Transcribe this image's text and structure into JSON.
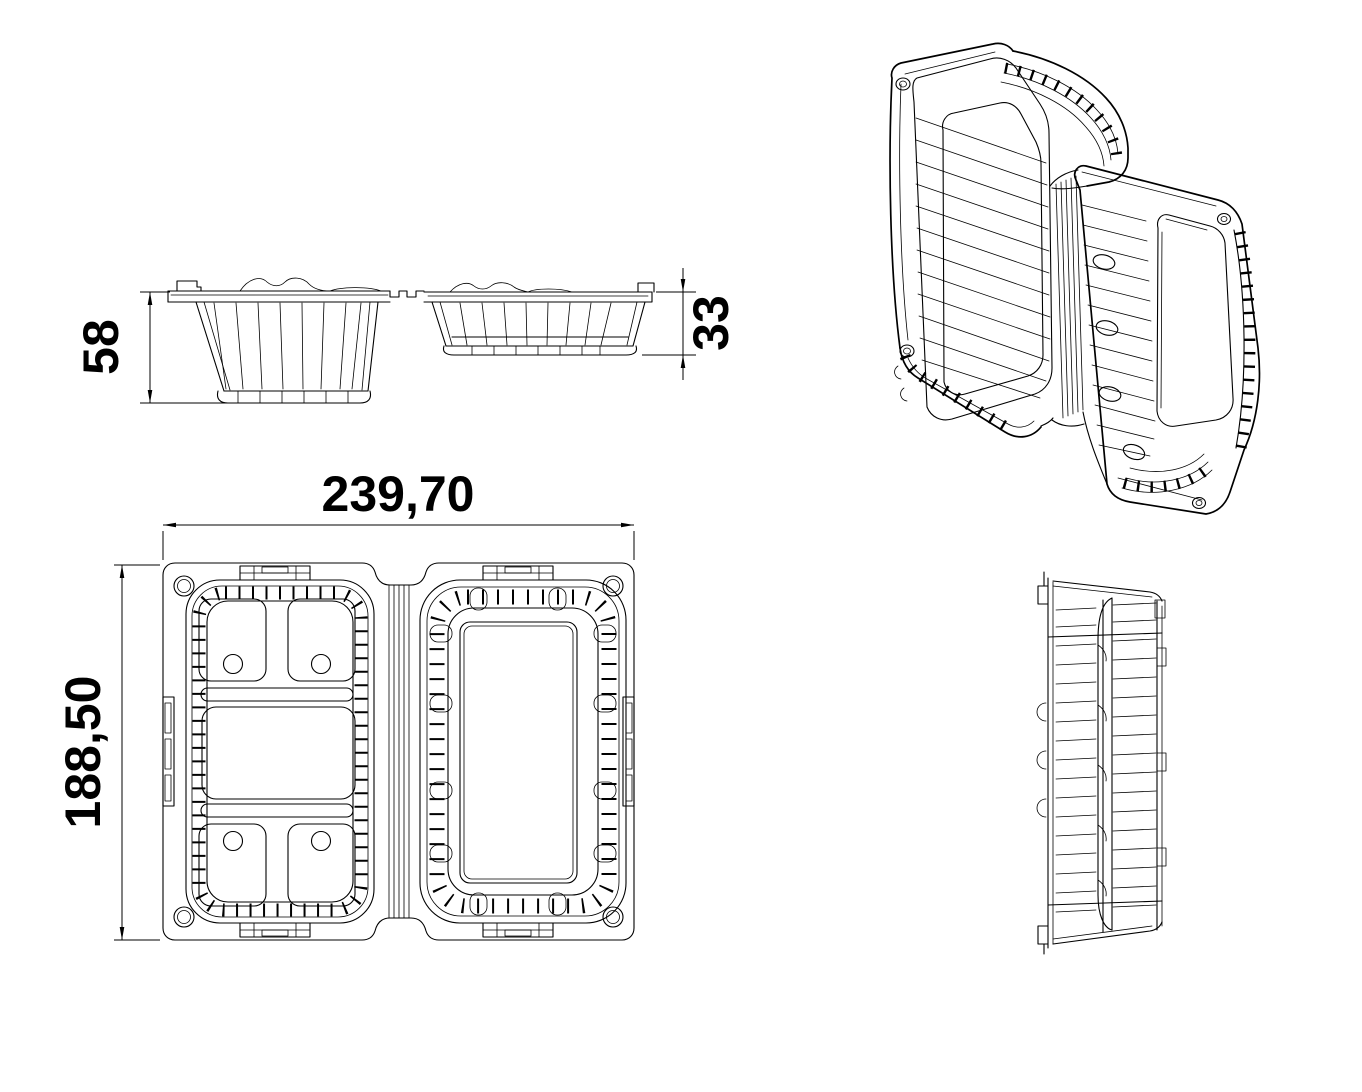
{
  "dimensions": {
    "overall_length": "239,70",
    "overall_width": "188,50",
    "base_depth": "58",
    "lid_depth": "33"
  },
  "colors": {
    "background": "#ffffff",
    "line": "#000000"
  }
}
